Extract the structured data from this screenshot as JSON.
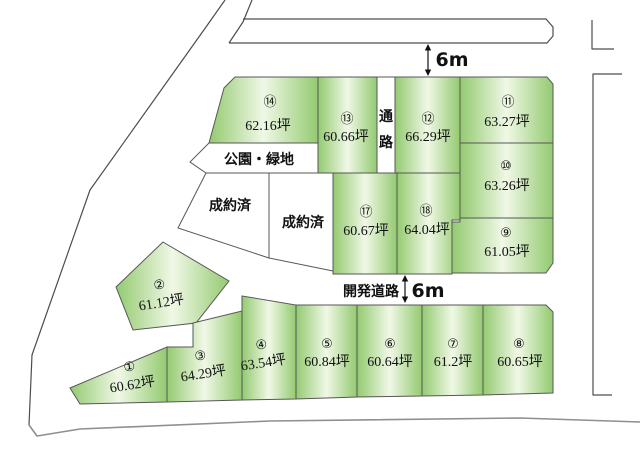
{
  "map": {
    "type": "land-subdivision-plan",
    "top_road_width_label": "6m",
    "development_road_label": "開発道路",
    "development_road_width_label": "6m",
    "passage_chars": [
      "通",
      "路"
    ],
    "park_label": "公園・緑地",
    "sold_labels": [
      "成約済",
      "成約済"
    ]
  },
  "plots": [
    {
      "no": "①",
      "area": "60.62坪"
    },
    {
      "no": "②",
      "area": "61.12坪"
    },
    {
      "no": "③",
      "area": "64.29坪"
    },
    {
      "no": "④",
      "area": "63.54坪"
    },
    {
      "no": "⑤",
      "area": "60.84坪"
    },
    {
      "no": "⑥",
      "area": "60.64坪"
    },
    {
      "no": "⑦",
      "area": "61.2坪"
    },
    {
      "no": "⑧",
      "area": "60.65坪"
    },
    {
      "no": "⑨",
      "area": "61.05坪"
    },
    {
      "no": "⑩",
      "area": "63.26坪"
    },
    {
      "no": "⑪",
      "area": "63.27坪"
    },
    {
      "no": "⑫",
      "area": "66.29坪"
    },
    {
      "no": "⑬",
      "area": "60.66坪"
    },
    {
      "no": "⑭",
      "area": "62.16坪"
    },
    {
      "no": "⑰",
      "area": "60.67坪"
    },
    {
      "no": "⑱",
      "area": "64.04坪"
    }
  ],
  "colors": {
    "plot_green_edge": "#93ca70",
    "plot_green_center": "#f0f8e6",
    "outline": "#575757",
    "road_line": "#4d4d4d",
    "outer_road_gray": "#8f8f8f",
    "background": "#ffffff"
  }
}
